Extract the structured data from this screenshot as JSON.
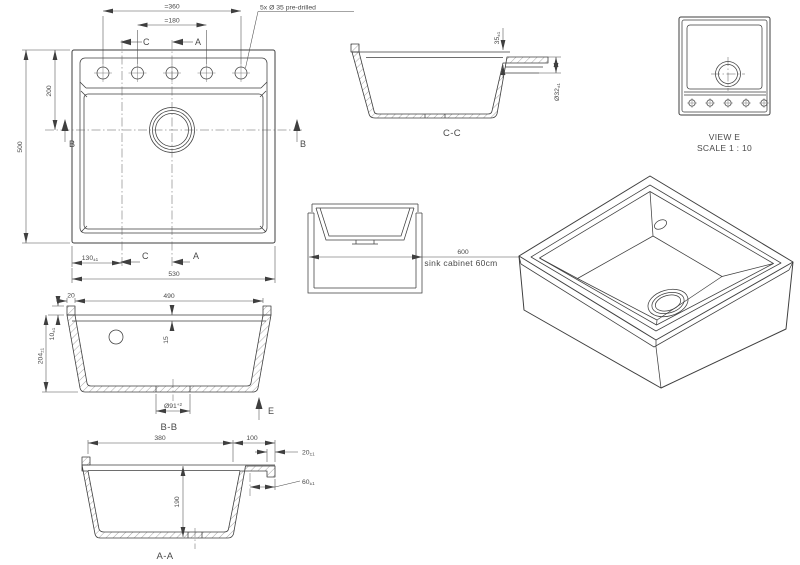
{
  "meta": {
    "background": "#ffffff",
    "line_color": "#3f3f3f",
    "text_color": "#4a4a4a"
  },
  "plan_view": {
    "dim_holes_span": "=360",
    "dim_holes_inner": "=180",
    "note_predrilled": "5x Ø 35 pre-drilled",
    "dim_height": "500",
    "dim_top_to_centre": "200",
    "dim_left_to_c": "130",
    "dim_left_to_c_tol": "±1",
    "dim_width": "530",
    "label_a": "A",
    "label_b": "B",
    "label_c": "C"
  },
  "section_cc": {
    "label": "C-C",
    "dim_rim_to_ledge": "35",
    "dim_rim_to_ledge_tol": "±1",
    "dim_overflow": "Ø32",
    "dim_overflow_tol": "±1"
  },
  "view_e": {
    "label": "VIEW E",
    "scale": "SCALE 1 : 10"
  },
  "cabinet_view": {
    "dim_width": "600",
    "note": "sink cabinet 60cm"
  },
  "section_bb": {
    "label": "B-B",
    "label_e": "E",
    "dim_lip": "20",
    "dim_inner_width": "490",
    "dim_lip_height": "10",
    "dim_lip_height_tol": "±1",
    "dim_depth": "204",
    "dim_depth_tol": "±1",
    "dim_rim": "15",
    "dim_drain": "Ø91",
    "dim_drain_tol": "+2"
  },
  "section_aa": {
    "label": "A-A",
    "dim_inner_width": "380",
    "dim_right_ext": "100",
    "dim_ledge_width": "20",
    "dim_ledge_width_tol": "±1",
    "dim_ledge_depth": "60",
    "dim_ledge_depth_tol": "±1",
    "dim_depth": "190"
  }
}
